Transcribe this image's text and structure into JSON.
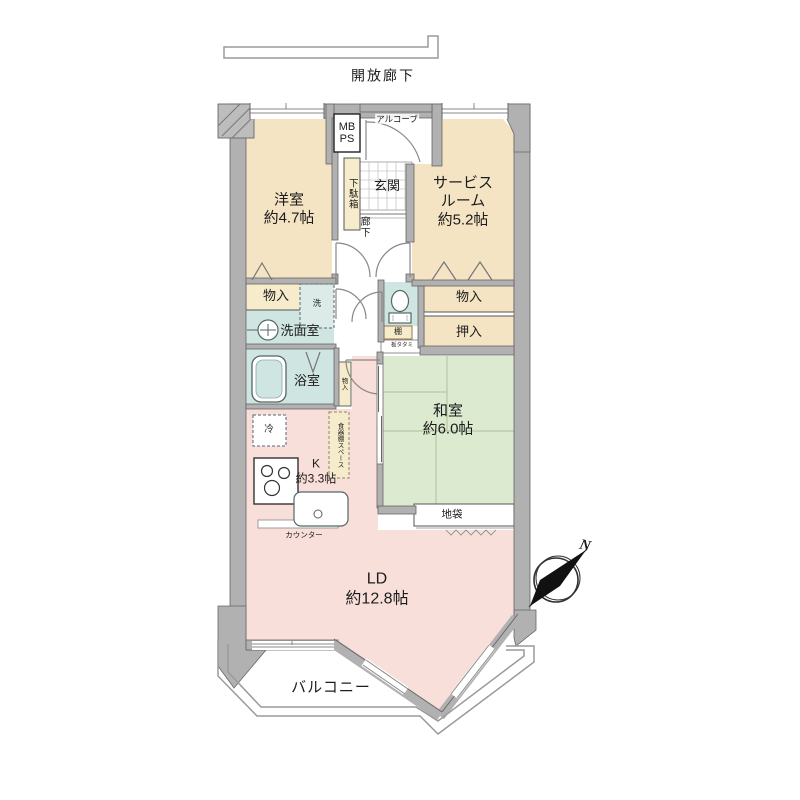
{
  "colors": {
    "wall": "#b1b1b1",
    "wall_edge": "#666666",
    "room_beige": "#f4e4c4",
    "room_green": "#dcead0",
    "room_blue": "#cfe5e1",
    "room_pink": "#f8dfda",
    "label_cream": "#f6eccb"
  },
  "plan": {
    "open_corridor": "開放廊下",
    "alcove": "アルコーブ",
    "meter_box": "MB",
    "pipe_space": "PS",
    "shoe_cabinet": "下駄箱",
    "entrance": "玄関",
    "hallway": "廊下",
    "rooms": {
      "western": {
        "name": "洋室",
        "size": "約4.7帖"
      },
      "service": {
        "name_line1": "サービス",
        "name_line2": "ルーム",
        "size": "約5.2帖"
      },
      "japanese": {
        "name": "和室",
        "size": "約6.0帖"
      },
      "kitchen": {
        "name": "K",
        "size": "約3.3帖"
      },
      "living_dining": {
        "name": "LD",
        "size": "約12.8帖"
      },
      "washroom": "洗面室",
      "bathroom": "浴室"
    },
    "fixtures": {
      "storage_left": "物入",
      "storage_right": "物入",
      "storage_hall": "物入",
      "closet": "押入",
      "shelf": "棚",
      "board_tatami": "板タタミ",
      "floor_cabinet": "地袋",
      "washer": "洗",
      "fridge": "冷",
      "cupboard_space": "食器棚スペース",
      "counter": "カウンター"
    },
    "balcony": "バルコニー",
    "compass_north": "N"
  }
}
